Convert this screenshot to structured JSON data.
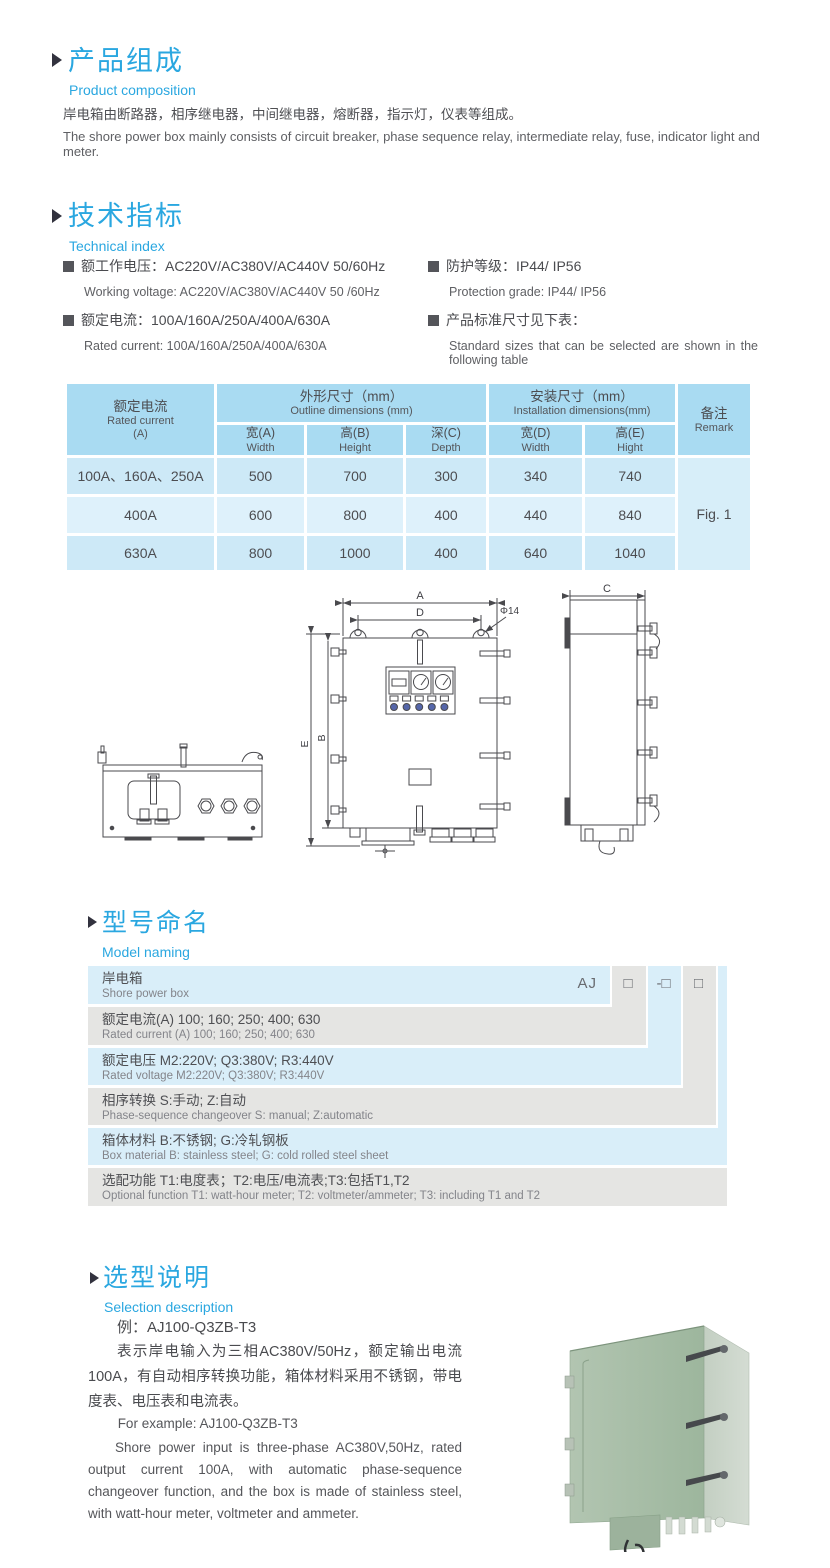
{
  "colors": {
    "accent_blue": "#2aa7e0",
    "table_header_blue": "#a9dbf2",
    "table_row_blue": "#cde9f7",
    "table_row_light": "#def1fb",
    "naming_row_blue": "#d9eef9",
    "naming_row_gray": "#e5e5e3",
    "photo_green": "#a8bfa8"
  },
  "product_composition": {
    "title_cn": "产品组成",
    "title_en": "Product  composition",
    "body_cn": "岸电箱由断路器，相序继电器，中间继电器，熔断器，指示灯，仪表等组成。",
    "body_en": "The shore power box mainly consists of circuit breaker, phase sequence relay, intermediate relay, fuse, indicator light and meter."
  },
  "technical_index": {
    "title_cn": "技术指标",
    "title_en": "Technical index",
    "items": [
      {
        "cn": "额工作电压：AC220V/AC380V/AC440V  50/60Hz",
        "en": "Working voltage: AC220V/AC380V/AC440V 50 /60Hz"
      },
      {
        "cn": "额定电流：100A/160A/250A/400A/630A",
        "en": "Rated current: 100A/160A/250A/400A/630A"
      },
      {
        "cn": "防护等级：IP44/ IP56",
        "en": "Protection grade: IP44/ IP56"
      },
      {
        "cn": "产品标准尺寸见下表：",
        "en": "Standard sizes that can be selected are shown in the following table"
      }
    ]
  },
  "dimensions_table": {
    "header": {
      "rated_current_cn": "额定电流",
      "rated_current_en": "Rated current",
      "rated_current_unit": "(A)",
      "outline_cn": "外形尺寸（mm）",
      "outline_en": "Outline dimensions (mm)",
      "install_cn": "安装尺寸（mm）",
      "install_en": "Installation dimensions(mm)",
      "remark_cn": "备注",
      "remark_en": "Remark",
      "cols": [
        {
          "cn": "宽(A)",
          "en": "Width"
        },
        {
          "cn": "高(B)",
          "en": "Height"
        },
        {
          "cn": "深(C)",
          "en": "Depth"
        },
        {
          "cn": "宽(D)",
          "en": "Width"
        },
        {
          "cn": "高(E)",
          "en": "Hight"
        }
      ]
    },
    "rows": [
      {
        "current": "100A、160A、250A",
        "w": "500",
        "h": "700",
        "d": "300",
        "iw": "340",
        "ih": "740"
      },
      {
        "current": "400A",
        "w": "600",
        "h": "800",
        "d": "400",
        "iw": "440",
        "ih": "840"
      },
      {
        "current": "630A",
        "w": "800",
        "h": "1000",
        "d": "400",
        "iw": "640",
        "ih": "1040"
      }
    ],
    "remark_value": "Fig. 1"
  },
  "drawing": {
    "labels": {
      "a": "A",
      "d": "D",
      "phi": "Φ14",
      "e": "E",
      "b": "B",
      "c": "C"
    }
  },
  "model_naming": {
    "title_cn": "型号命名",
    "title_en": "Model naming",
    "prefix": "AJ",
    "box1": "□",
    "box2": "-□",
    "box3": "□",
    "rows": [
      {
        "cn": "岸电箱",
        "en": "Shore power box"
      },
      {
        "cn": "额定电流(A)  100; 160; 250; 400; 630",
        "en": "Rated current (A) 100; 160; 250; 400; 630"
      },
      {
        "cn": "额定电压   M2:220V;  Q3:380V;  R3:440V",
        "en": "Rated voltage  M2:220V;  Q3:380V;  R3:440V"
      },
      {
        "cn": "相序转换  S:手动; Z:自动",
        "en": "Phase-sequence changeover  S: manual;  Z:automatic"
      },
      {
        "cn": "箱体材料    B:不锈钢;  G:冷轧钢板",
        "en": "Box material   B: stainless steel; G: cold rolled steel sheet"
      },
      {
        "cn": "选配功能      T1:电度表；T2:电压/电流表;T3:包括T1,T2",
        "en": "Optional function  T1: watt-hour meter; T2: voltmeter/ammeter; T3: including T1 and T2"
      }
    ]
  },
  "selection": {
    "title_cn": "选型说明",
    "title_en": "Selection description",
    "example_cn": "例：AJ100-Q3ZB-T3",
    "desc_cn": "表示岸电输入为三相AC380V/50Hz，额定输出电流100A，有自动相序转换功能，箱体材料采用不锈钢，带电度表、电压表和电流表。",
    "example_en": "For example: AJ100-Q3ZB-T3",
    "desc_en": "Shore power input is three-phase AC380V,50Hz, rated output current 100A, with automatic phase-sequence changeover function, and the box is made of stainless steel, with watt-hour meter, voltmeter and ammeter."
  }
}
